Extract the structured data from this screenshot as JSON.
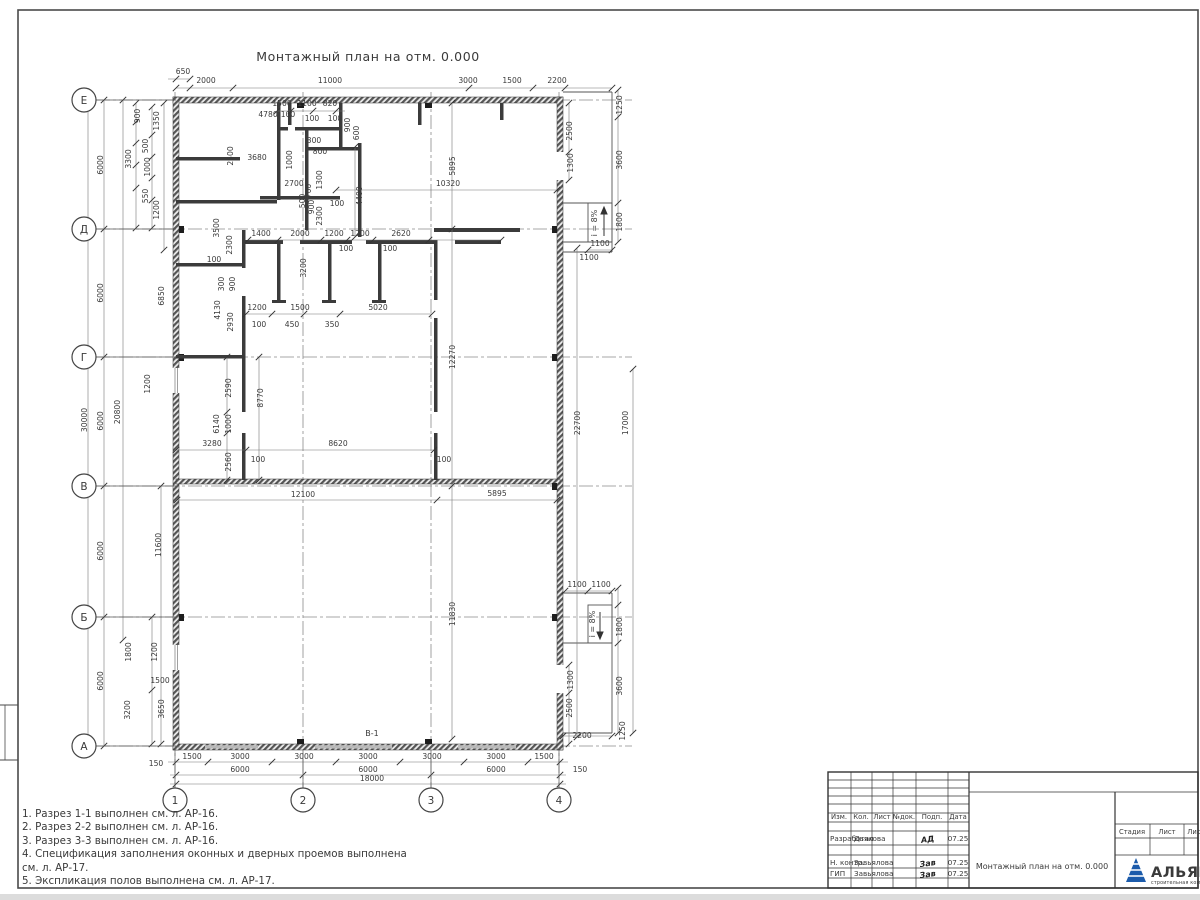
{
  "sheet": {
    "title": "Монтажный план на отм. 0.000"
  },
  "axes": {
    "rows": [
      {
        "label": "Е",
        "y": 100
      },
      {
        "label": "Д",
        "y": 229
      },
      {
        "label": "Г",
        "y": 357
      },
      {
        "label": "В",
        "y": 486
      },
      {
        "label": "Б",
        "y": 617
      },
      {
        "label": "А",
        "y": 746
      }
    ],
    "cols": [
      {
        "label": "1",
        "x": 175
      },
      {
        "label": "2",
        "x": 303
      },
      {
        "label": "3",
        "x": 431
      },
      {
        "label": "4",
        "x": 559
      }
    ]
  },
  "dimensions": [
    {
      "t": "650",
      "x": 183,
      "y": 74
    },
    {
      "t": "2000",
      "x": 206,
      "y": 83
    },
    {
      "t": "11000",
      "x": 330,
      "y": 83
    },
    {
      "t": "3000",
      "x": 468,
      "y": 83
    },
    {
      "t": "1500",
      "x": 512,
      "y": 83
    },
    {
      "t": "2200",
      "x": 557,
      "y": 83
    },
    {
      "t": "1500",
      "x": 192,
      "y": 759
    },
    {
      "t": "3000",
      "x": 240,
      "y": 759
    },
    {
      "t": "3000",
      "x": 304,
      "y": 759
    },
    {
      "t": "3000",
      "x": 368,
      "y": 759
    },
    {
      "t": "3000",
      "x": 432,
      "y": 759
    },
    {
      "t": "3000",
      "x": 496,
      "y": 759
    },
    {
      "t": "1500",
      "x": 544,
      "y": 759
    },
    {
      "t": "6000",
      "x": 240,
      "y": 772
    },
    {
      "t": "6000",
      "x": 368,
      "y": 772
    },
    {
      "t": "6000",
      "x": 496,
      "y": 772
    },
    {
      "t": "18000",
      "x": 372,
      "y": 781
    },
    {
      "t": "150",
      "x": 156,
      "y": 766
    },
    {
      "t": "150",
      "x": 580,
      "y": 772
    },
    {
      "t": "2200",
      "x": 582,
      "y": 738
    },
    {
      "t": "30000",
      "x": 87,
      "y": 420,
      "r": 1
    },
    {
      "t": "6000",
      "x": 103,
      "y": 165,
      "r": 1
    },
    {
      "t": "6000",
      "x": 103,
      "y": 293,
      "r": 1
    },
    {
      "t": "6000",
      "x": 103,
      "y": 421,
      "r": 1
    },
    {
      "t": "6000",
      "x": 103,
      "y": 551,
      "r": 1
    },
    {
      "t": "6000",
      "x": 103,
      "y": 681,
      "r": 1
    },
    {
      "t": "20800",
      "x": 120,
      "y": 412,
      "r": 1
    },
    {
      "t": "3300",
      "x": 131,
      "y": 159,
      "r": 1
    },
    {
      "t": "900",
      "x": 140,
      "y": 116,
      "r": 1
    },
    {
      "t": "1350",
      "x": 159,
      "y": 121,
      "r": 1
    },
    {
      "t": "500",
      "x": 148,
      "y": 146,
      "r": 1
    },
    {
      "t": "1000",
      "x": 150,
      "y": 167,
      "r": 1
    },
    {
      "t": "550",
      "x": 148,
      "y": 196,
      "r": 1
    },
    {
      "t": "1200",
      "x": 159,
      "y": 210,
      "r": 1
    },
    {
      "t": "6850",
      "x": 164,
      "y": 296,
      "r": 1
    },
    {
      "t": "1200",
      "x": 150,
      "y": 384,
      "r": 1
    },
    {
      "t": "11600",
      "x": 161,
      "y": 545,
      "r": 1
    },
    {
      "t": "1800",
      "x": 131,
      "y": 652,
      "r": 1
    },
    {
      "t": "1200",
      "x": 157,
      "y": 652,
      "r": 1
    },
    {
      "t": "1500",
      "x": 160,
      "y": 683
    },
    {
      "t": "3200",
      "x": 130,
      "y": 710,
      "r": 1
    },
    {
      "t": "3650",
      "x": 164,
      "y": 709,
      "r": 1
    },
    {
      "t": "4780",
      "x": 268,
      "y": 117
    },
    {
      "t": "2500",
      "x": 233,
      "y": 156,
      "r": 1
    },
    {
      "t": "3680",
      "x": 257,
      "y": 160
    },
    {
      "t": "300",
      "x": 314,
      "y": 143
    },
    {
      "t": "800",
      "x": 320,
      "y": 154
    },
    {
      "t": "1500",
      "x": 282,
      "y": 106
    },
    {
      "t": "1100",
      "x": 307,
      "y": 106
    },
    {
      "t": "820",
      "x": 330,
      "y": 106
    },
    {
      "t": "100",
      "x": 288,
      "y": 117
    },
    {
      "t": "100",
      "x": 312,
      "y": 121
    },
    {
      "t": "100",
      "x": 335,
      "y": 121
    },
    {
      "t": "900",
      "x": 350,
      "y": 125,
      "r": 1
    },
    {
      "t": "600",
      "x": 359,
      "y": 133,
      "r": 1
    },
    {
      "t": "1000",
      "x": 292,
      "y": 160,
      "r": 1
    },
    {
      "t": "1300",
      "x": 322,
      "y": 180,
      "r": 1
    },
    {
      "t": "700",
      "x": 311,
      "y": 191,
      "r": 1
    },
    {
      "t": "2700",
      "x": 294,
      "y": 186
    },
    {
      "t": "500",
      "x": 305,
      "y": 201,
      "r": 1
    },
    {
      "t": "900",
      "x": 314,
      "y": 207,
      "r": 1
    },
    {
      "t": "2300",
      "x": 322,
      "y": 216,
      "r": 1
    },
    {
      "t": "4400",
      "x": 362,
      "y": 196,
      "r": 1
    },
    {
      "t": "100",
      "x": 337,
      "y": 206
    },
    {
      "t": "3500",
      "x": 219,
      "y": 228,
      "r": 1
    },
    {
      "t": "2300",
      "x": 232,
      "y": 245,
      "r": 1
    },
    {
      "t": "300",
      "x": 224,
      "y": 284,
      "r": 1
    },
    {
      "t": "900",
      "x": 235,
      "y": 284,
      "r": 1
    },
    {
      "t": "100",
      "x": 214,
      "y": 262
    },
    {
      "t": "5895",
      "x": 455,
      "y": 166,
      "r": 1
    },
    {
      "t": "10320",
      "x": 448,
      "y": 186
    },
    {
      "t": "1400",
      "x": 261,
      "y": 236
    },
    {
      "t": "2000",
      "x": 300,
      "y": 236
    },
    {
      "t": "1200",
      "x": 334,
      "y": 236
    },
    {
      "t": "1200",
      "x": 360,
      "y": 236
    },
    {
      "t": "2620",
      "x": 401,
      "y": 236
    },
    {
      "t": "100",
      "x": 346,
      "y": 251
    },
    {
      "t": "100",
      "x": 390,
      "y": 251
    },
    {
      "t": "3200",
      "x": 306,
      "y": 268,
      "r": 1
    },
    {
      "t": "4130",
      "x": 220,
      "y": 310,
      "r": 1
    },
    {
      "t": "2930",
      "x": 233,
      "y": 322,
      "r": 1
    },
    {
      "t": "1200",
      "x": 257,
      "y": 310
    },
    {
      "t": "1500",
      "x": 300,
      "y": 310
    },
    {
      "t": "450",
      "x": 292,
      "y": 327
    },
    {
      "t": "350",
      "x": 332,
      "y": 327
    },
    {
      "t": "100",
      "x": 259,
      "y": 327
    },
    {
      "t": "5020",
      "x": 378,
      "y": 310
    },
    {
      "t": "2590",
      "x": 231,
      "y": 388,
      "r": 1
    },
    {
      "t": "6140",
      "x": 219,
      "y": 424,
      "r": 1
    },
    {
      "t": "1000",
      "x": 231,
      "y": 424,
      "r": 1
    },
    {
      "t": "8770",
      "x": 263,
      "y": 398,
      "r": 1
    },
    {
      "t": "3280",
      "x": 212,
      "y": 446
    },
    {
      "t": "8620",
      "x": 338,
      "y": 446
    },
    {
      "t": "2560",
      "x": 231,
      "y": 462,
      "r": 1
    },
    {
      "t": "100",
      "x": 258,
      "y": 462
    },
    {
      "t": "100",
      "x": 444,
      "y": 462
    },
    {
      "t": "12100",
      "x": 303,
      "y": 497
    },
    {
      "t": "5895",
      "x": 497,
      "y": 496
    },
    {
      "t": "12270",
      "x": 455,
      "y": 357,
      "r": 1
    },
    {
      "t": "22700",
      "x": 580,
      "y": 423,
      "r": 1
    },
    {
      "t": "17000",
      "x": 628,
      "y": 423,
      "r": 1
    },
    {
      "t": "11830",
      "x": 455,
      "y": 614,
      "r": 1
    },
    {
      "t": "1250",
      "x": 622,
      "y": 105,
      "r": 1
    },
    {
      "t": "2500",
      "x": 572,
      "y": 131,
      "r": 1
    },
    {
      "t": "3600",
      "x": 622,
      "y": 160,
      "r": 1
    },
    {
      "t": "1300",
      "x": 573,
      "y": 163,
      "r": 1
    },
    {
      "t": "1800",
      "x": 622,
      "y": 222,
      "r": 1
    },
    {
      "t": "1100",
      "x": 600,
      "y": 246
    },
    {
      "t": "1100",
      "x": 589,
      "y": 260
    },
    {
      "t": "1100",
      "x": 577,
      "y": 587
    },
    {
      "t": "1100",
      "x": 601,
      "y": 587
    },
    {
      "t": "1800",
      "x": 622,
      "y": 627,
      "r": 1
    },
    {
      "t": "3600",
      "x": 622,
      "y": 686,
      "r": 1
    },
    {
      "t": "1300",
      "x": 573,
      "y": 680,
      "r": 1
    },
    {
      "t": "2500",
      "x": 572,
      "y": 708,
      "r": 1
    },
    {
      "t": "1250",
      "x": 625,
      "y": 731,
      "r": 1
    }
  ],
  "labels": [
    {
      "t": "В-1",
      "x": 372,
      "y": 736
    },
    {
      "t": "i = 8%",
      "x": 597,
      "y": 223,
      "r": 1
    },
    {
      "t": "i = 8%",
      "x": 595,
      "y": 624,
      "r": 1
    }
  ],
  "notes": [
    "1. Разрез 1-1 выполнен см. л. АР-16.",
    "2. Разрез 2-2 выполнен см. л. АР-16.",
    "3. Разрез 3-3 выполнен см. л. АР-16.",
    "4. Спецификация заполнения оконных и дверных проемов выполнена",
    "см. л. АР-17.",
    "5. Экспликация полов выполнена см. л. АР-17."
  ],
  "titleblock": {
    "header_cols": [
      "Изм.",
      "Кол.",
      "Лист",
      "№док.",
      "Подп.",
      "Дата"
    ],
    "rows": [
      {
        "role": "Разработал",
        "name": "Дьякова",
        "sig": "АД",
        "date": "07.25"
      },
      {
        "role": "Н. контр.",
        "name": "Завьялова",
        "sig": "Зав",
        "date": "07.25"
      },
      {
        "role": "ГИП",
        "name": "Завьялова",
        "sig": "Зав",
        "date": "07.25"
      }
    ],
    "doc_title": "Монтажный план на отм. 0.000",
    "stage_cols": [
      "Стадия",
      "Лист",
      "Листов"
    ],
    "logo": {
      "name": "АЛЬЯНС",
      "sub": "строительная компания",
      "color": "#1b5bab"
    }
  }
}
